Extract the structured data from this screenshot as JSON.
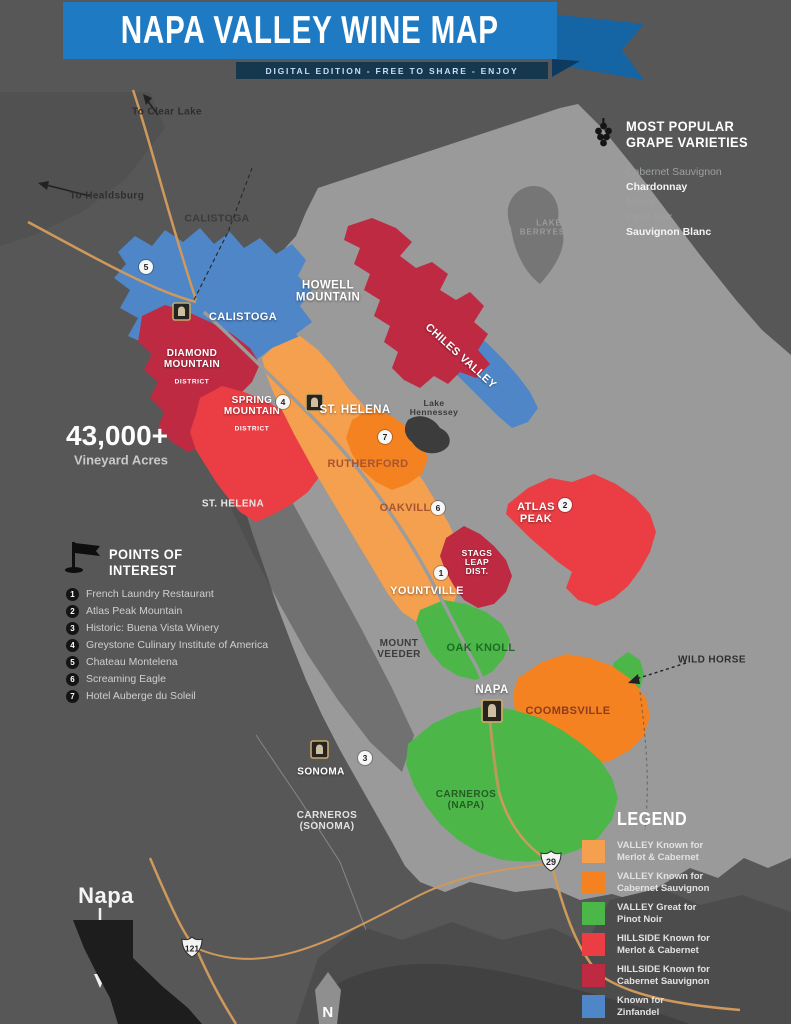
{
  "header": {
    "title": "NAPA VALLEY WINE MAP",
    "subtitle": "DIGITAL EDITION - FREE TO SHARE - ENJOY"
  },
  "colors": {
    "banner_blue": "#1E7AC2",
    "valley_merlot_cab": "#F5A04E",
    "valley_cab_sauv": "#F58220",
    "valley_pinot": "#4CB748",
    "hillside_merlot_cab": "#EA3E44",
    "hillside_cab_sauv": "#BE2A42",
    "zinfandel_blue": "#4E86C8",
    "road_orange": "#CF995C"
  },
  "stats": {
    "value": "43,000+",
    "label": "Vineyard Acres"
  },
  "grapes": {
    "title": "MOST POPULAR\nGRAPE VARIETIES",
    "items": [
      "Cabernet Sauvignon",
      "Chardonnay",
      "Merlot",
      "Pinot Noir",
      "Sauvignon Blanc"
    ]
  },
  "poi": {
    "title": "POINTS OF\nINTEREST",
    "items": [
      {
        "num": "1",
        "name": "French Laundry Restaurant"
      },
      {
        "num": "2",
        "name": "Atlas Peak Mountain"
      },
      {
        "num": "3",
        "name": "Historic: Buena Vista Winery"
      },
      {
        "num": "4",
        "name": "Greystone Culinary Institute of America"
      },
      {
        "num": "5",
        "name": "Chateau Montelena"
      },
      {
        "num": "6",
        "name": "Screaming Eagle"
      },
      {
        "num": "7",
        "name": "Hotel Auberge du Soleil"
      }
    ]
  },
  "legend": {
    "title": "LEGEND",
    "items": [
      {
        "color": "#F5A04E",
        "label": "VALLEY Known for\nMerlot & Cabernet"
      },
      {
        "color": "#F58220",
        "label": "VALLEY Known for\nCabernet Sauvignon"
      },
      {
        "color": "#4CB748",
        "label": "VALLEY Great for\nPinot Noir"
      },
      {
        "color": "#EA3E44",
        "label": "HILLSIDE Known for\nMerlot & Cabernet"
      },
      {
        "color": "#BE2A42",
        "label": "HILLSIDE Known for\nCabernet Sauvignon"
      },
      {
        "color": "#4E86C8",
        "label": "Known for\nZinfandel"
      }
    ]
  },
  "map": {
    "labels": {
      "to_clear_lake": "To Clear Lake",
      "to_healdsburg": "To Healdsburg",
      "calistoga_area": "CALISTOGA",
      "calistoga_town": "CALISTOGA",
      "howell": "HOWELL\nMOUNTAIN",
      "chiles": "CHILES VALLEY",
      "diamond": "DIAMOND\nMOUNTAIN",
      "diamond_sub": "DISTRICT",
      "spring": "SPRING\nMOUNTAIN",
      "spring_sub": "DISTRICT",
      "st_helena_town": "ST. HELENA",
      "st_helena_mtn": "ST. HELENA",
      "lake_hennessey": "Lake\nHennessey",
      "lake_berryessa": "LAKE\nBERRYESSA",
      "rutherford": "RUTHERFORD",
      "oakville": "OAKVILLE",
      "atlas_peak": "ATLAS\nPEAK",
      "stags_leap": "STAGS\nLEAP\nDIST.",
      "yountville": "YOUNTVILLE",
      "mount_veeder": "MOUNT\nVEEDER",
      "oak_knoll": "OAK KNOLL",
      "napa_town": "NAPA",
      "coombsville": "COOMBSVILLE",
      "wild_horse": "WILD HORSE",
      "sonoma": "SONOMA",
      "carneros_napa": "CARNEROS\n(NAPA)",
      "carneros_sonoma": "CARNEROS\n(SONOMA)",
      "napa_state": "Napa",
      "compass_n": "N"
    },
    "markers": [
      {
        "num": "1"
      },
      {
        "num": "2"
      },
      {
        "num": "3"
      },
      {
        "num": "4"
      },
      {
        "num": "5"
      },
      {
        "num": "6"
      },
      {
        "num": "7"
      }
    ],
    "highways": {
      "route_121": "121",
      "route_29": "29"
    }
  }
}
